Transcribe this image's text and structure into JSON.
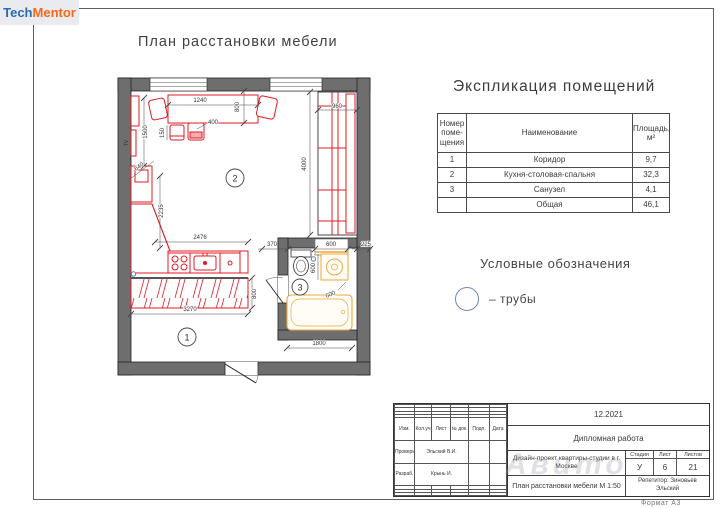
{
  "logo": {
    "part1": "Tech",
    "part2": "Mentor"
  },
  "drawing": {
    "title": "План расстановки мебели"
  },
  "plan": {
    "tv": "TV",
    "rooms": {
      "r1": "1",
      "r2": "2",
      "r3": "3"
    },
    "dims": {
      "table_width": "1240",
      "gap_800": "800",
      "sofa_width": "960",
      "sofa_length": "4000",
      "tv_wall": "1500",
      "stool": "150",
      "stool_offset": "400",
      "corner": "640",
      "kitchen_wall": "2235",
      "counter": "2476",
      "wc_wall": "370",
      "wc_shelf": "600",
      "wall_ext": "225",
      "washer_depth": "600",
      "washer_width": "600",
      "wardrobe_depth": "800",
      "wardrobe_length": "3270",
      "bath_length": "1800"
    }
  },
  "explication": {
    "title": "Экспликация помещений",
    "headers": {
      "number": "Номер поме-щения",
      "name": "Наименование",
      "area": "Площадь, м²"
    },
    "rows": [
      {
        "number": "1",
        "name": "Коридор",
        "area": "9,7"
      },
      {
        "number": "2",
        "name": "Кухня-столовая-спальня",
        "area": "32,3"
      },
      {
        "number": "3",
        "name": "Санузел",
        "area": "4,1"
      },
      {
        "number": "",
        "name": "Общая",
        "area": "46,1"
      }
    ]
  },
  "legend": {
    "title": "Условные обозначения",
    "pipe_label": "– трубы"
  },
  "titleblock": {
    "date": "12.2021",
    "work_type": "Дипломная работа",
    "project": "Дизайн-проект квартиры-студии в г. Москве",
    "sheet_name": "План расстановки мебели М 1:50",
    "tutor": "Репетитор: Зиновьев Эльский",
    "columns": {
      "izm": "Изм.",
      "koluch": "Кол.уч",
      "list": "Лист",
      "ndok": "№ док.",
      "podp": "Подп.",
      "data": "Дата"
    },
    "signers": [
      {
        "role": "Проверил",
        "name": "Эльский В.И."
      },
      {
        "role": "Разраб.",
        "name": "Крынь И."
      }
    ],
    "stage": {
      "label": "Стадия",
      "value": "У"
    },
    "sheet": {
      "label": "Лист",
      "value": "6"
    },
    "sheets": {
      "label": "Листов",
      "value": "21"
    }
  },
  "footer": {
    "format_label": "Формат А3"
  },
  "watermark": {
    "text": "Авито"
  },
  "colors": {
    "accent_red": "#e11b22",
    "fixture_orange": "#eda53a",
    "wall_gray": "#6e6e6e",
    "pipe_blue": "#5b79b0",
    "logo_blue": "#2b6cb0",
    "logo_orange": "#f26a1e"
  }
}
